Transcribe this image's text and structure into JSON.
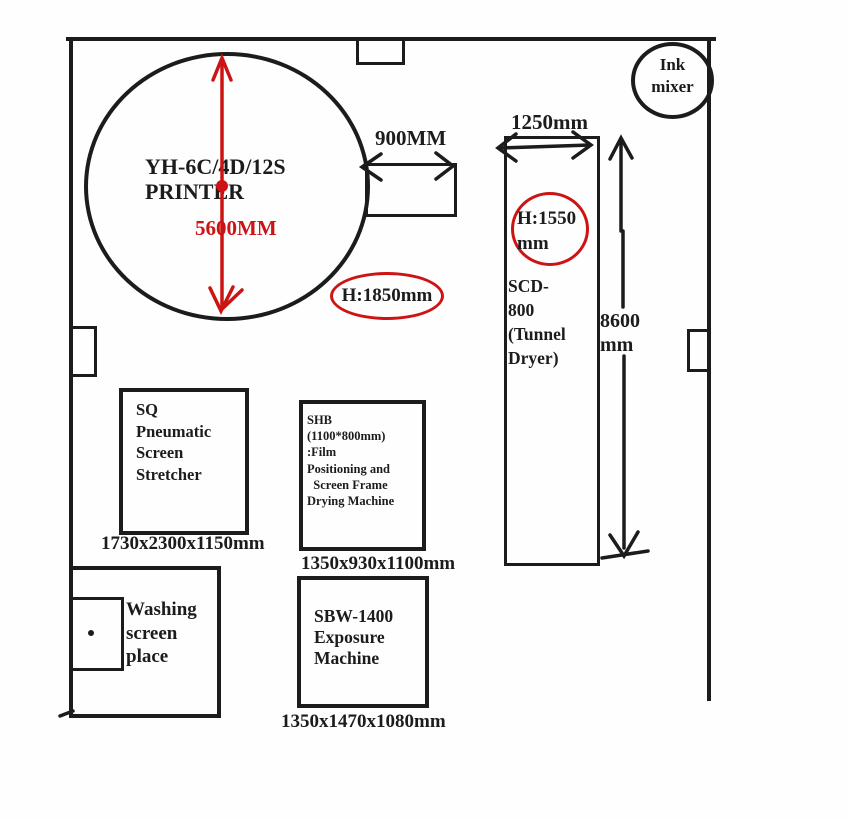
{
  "colors": {
    "ink": "#1c1c1c",
    "red": "#cd1414",
    "background": "#fefefe"
  },
  "machines": {
    "printer": {
      "label": "YH-6C/4D/12S\nPRINTER",
      "diameter": "5600MM",
      "outfeed_width": "900MM",
      "height_note": "H:1850mm"
    },
    "tunnel_dryer": {
      "label": "SCD-\n800\n(Tunnel\nDryer)",
      "width": "1250mm",
      "length": "8600\nmm",
      "height_note": "H:1550\nmm"
    },
    "ink_mixer": {
      "label": "Ink\nmixer"
    },
    "screen_stretcher": {
      "label": "SQ\nPneumatic\nScreen\nStretcher",
      "dims": "1730x2300x1150mm"
    },
    "film_drying": {
      "label": "SHB\n(1100*800mm)\n:Film\nPositioning and\n  Screen Frame\nDrying Machine",
      "dims": "1350x930x1100mm"
    },
    "exposure": {
      "label": "SBW-1400\nExposure\nMachine",
      "dims": "1350x1470x1080mm"
    },
    "washing": {
      "label": "Washing\nscreen\nplace"
    }
  }
}
